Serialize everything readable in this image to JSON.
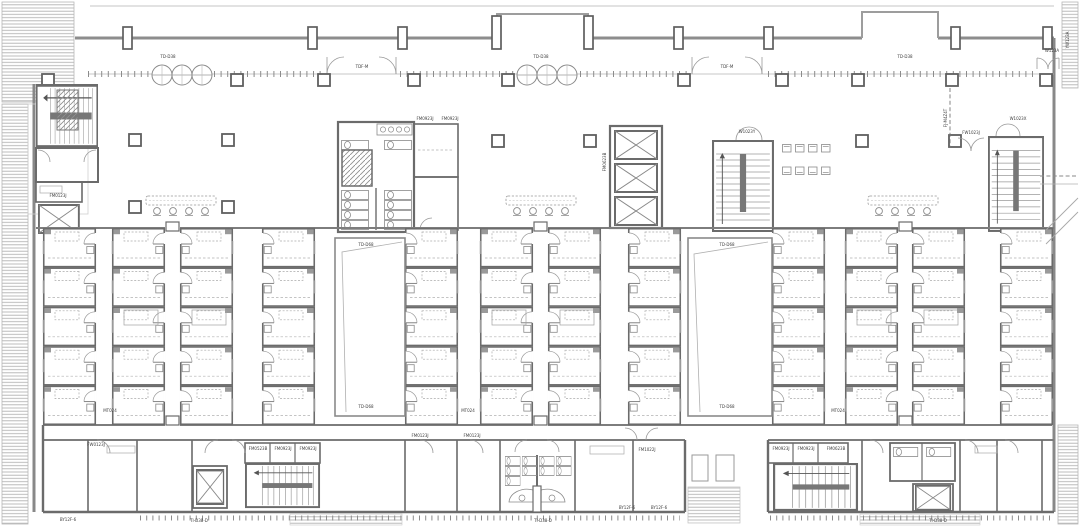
{
  "palette": {
    "paper": "#ffffff",
    "wall_heavy": "#6b6b6b",
    "wall_light": "#9a9a9a",
    "hatch": "#b4b4b4",
    "text": "#3c3c3c"
  },
  "labels": {
    "td_d38_a": "TD-D38",
    "td_d38_b": "TD-D38",
    "td_d38_c": "TD-D38",
    "tdf_m_a": "TDF-M",
    "tdf_m_b": "TDF-M",
    "td_d68_a1": "TD-D68",
    "td_d68_a2": "TD-D68",
    "td_d68_b1": "TD-D68",
    "td_d68_b2": "TD-D68",
    "fm0923j_wc_a": "FM0923J",
    "fm0923j_wc_b": "FM0923J",
    "fm0123j_vest": "FM0123J",
    "fm0623b_elev": "FM0623B",
    "w1023y_stair": "W1023Y",
    "fj_m4z4t": "FJ-M4Z4T",
    "fw1023j_door": "FW1023J",
    "w1023x_stair": "W1023X",
    "w123a_door": "W123A",
    "yw123a_edge": "YW123A",
    "mt024_a": "MT024",
    "mt024_b": "MT024",
    "mt024_c": "MT024",
    "fw0123j_bl": "FW0123J",
    "fm0523b_bl": "FM0523B",
    "fm0923j_bl_a": "FM0923J",
    "fm0923j_bl_b": "FM0923J",
    "fm0123j_bm_a": "FM0123J",
    "fm0123j_bm_b": "FM0123J",
    "fm1022j_bm": "FM1022J",
    "by12f_a": "BY12F-6",
    "by12f_b": "BY12F-6",
    "by12f_c": "BY12F-6",
    "fm0923j_br_a": "FM0923J",
    "fm0923j_br_b": "FM0923J",
    "fm0623b_br": "FM0623B",
    "ti_d38_a": "TI-D38-D",
    "ti_d38_b": "TI-D38-D",
    "ti_d38_c": "TI-D38-D"
  }
}
